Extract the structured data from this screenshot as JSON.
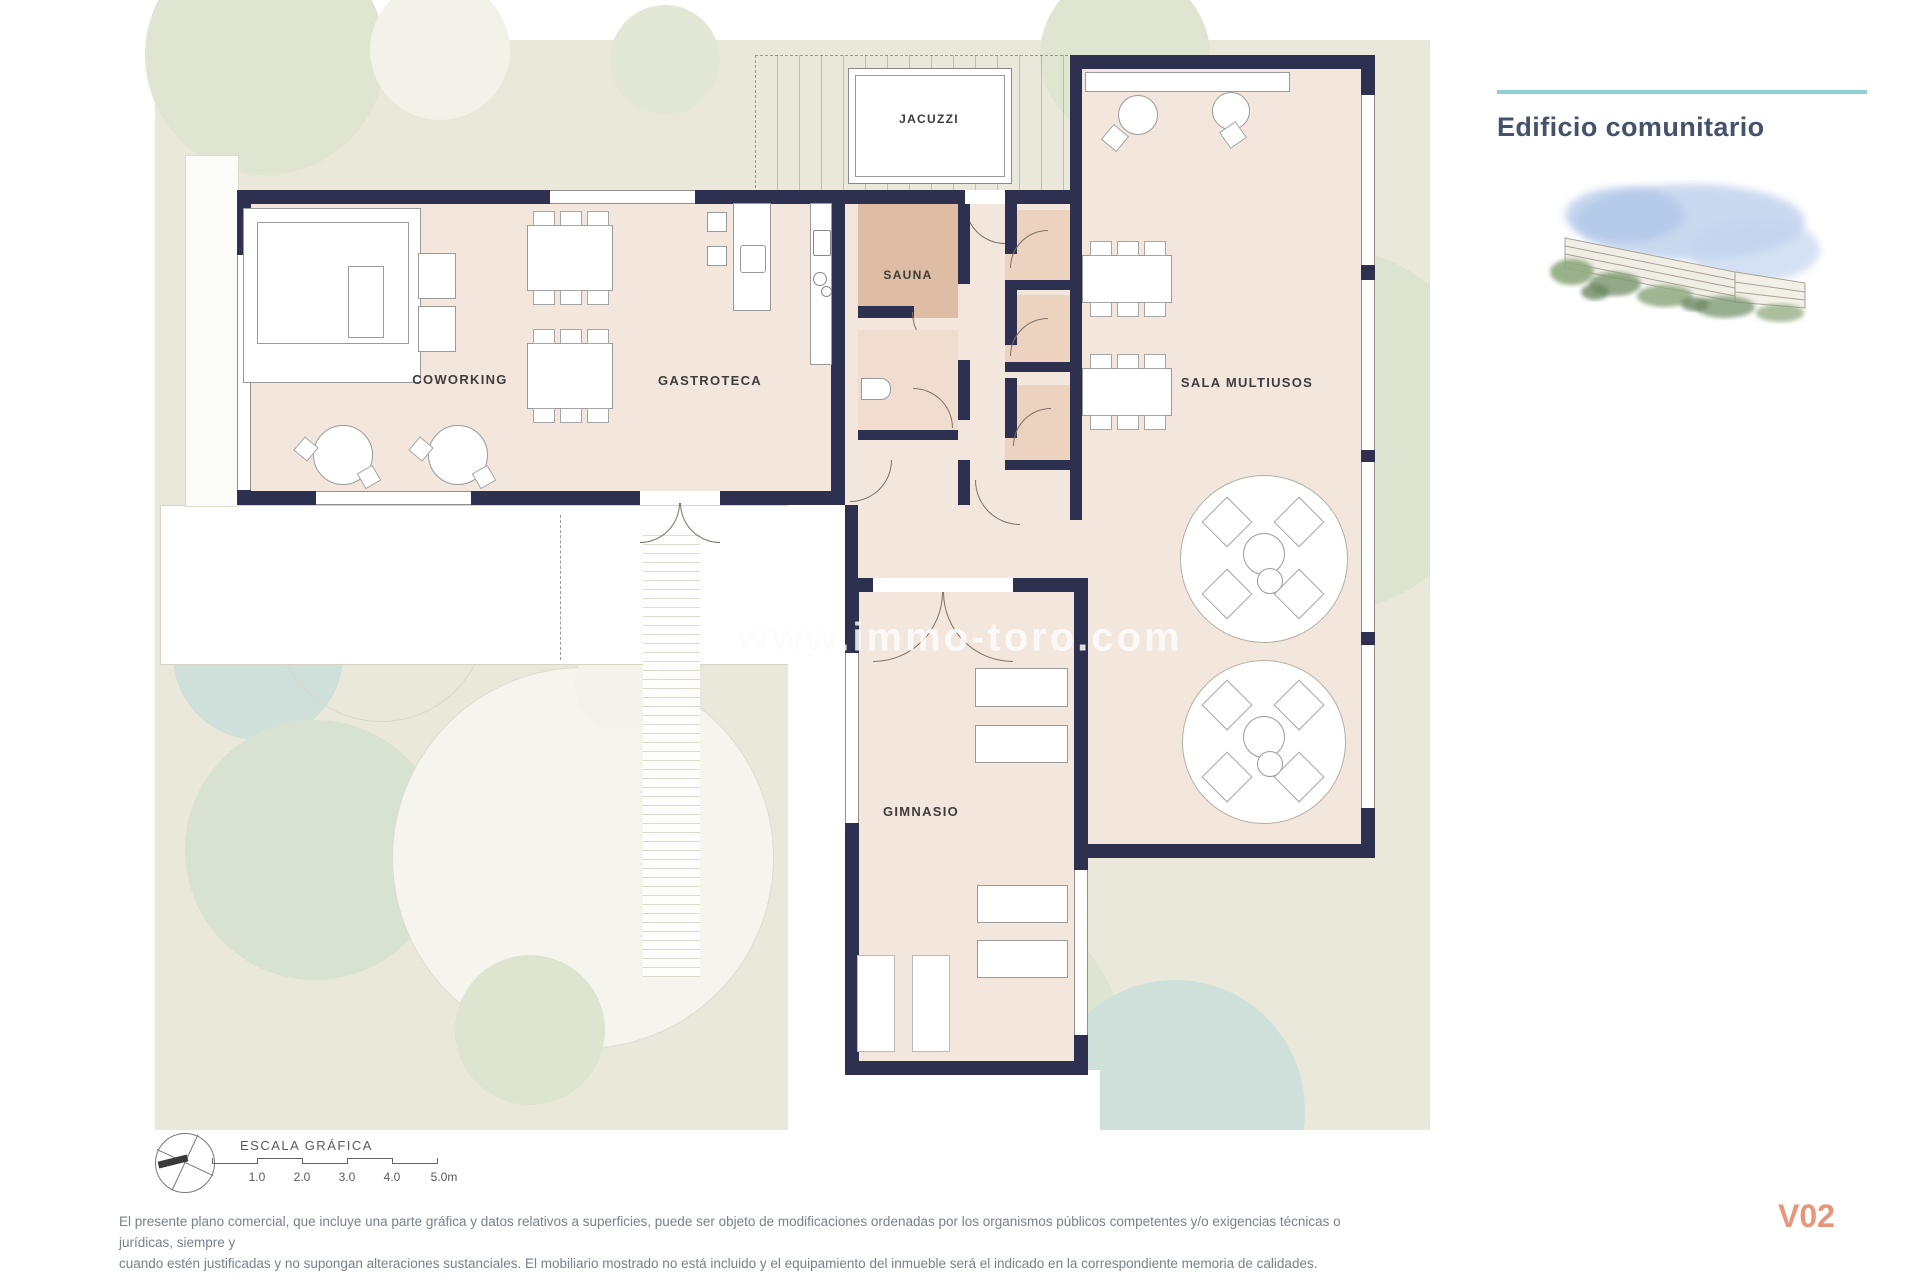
{
  "header": {
    "title": "Edificio comunitario"
  },
  "plan": {
    "room_labels": {
      "jacuzzi": "JACUZZI",
      "sauna": "SAUNA",
      "coworking": "COWORKING",
      "gastroteca": "GASTROTECA",
      "sala_multiusos": "SALA MULTIUSOS",
      "gimnasio": "GIMNASIO"
    },
    "watermark": "www.immo-toro.com"
  },
  "scale_bar": {
    "label": "ESCALA GRÁFICA",
    "ticks": [
      "1.0",
      "2.0",
      "3.0",
      "4.0",
      "5.0m"
    ]
  },
  "footer": {
    "disclaimer_line1": "El presente plano comercial, que incluye una parte gráfica y datos relativos a superficies, puede ser objeto de modificaciones ordenadas por los organismos públicos competentes y/o exigencias técnicas o jurídicas, siempre y",
    "disclaimer_line2": "cuando estén justificadas y no supongan alteraciones sustanciales. El mobiliario mostrado no está incluido y el equipamiento del inmueble será el indicado en la correspondiente memoria de calidades.",
    "version": "V02"
  },
  "colors": {
    "accent_teal": "#8ed0d4",
    "wall_navy": "#2e3050",
    "floor_pink": "#f3e6dd",
    "sauna_fill": "#dfbca4",
    "plan_background": "#e9e8da",
    "version_coral": "#e9957a",
    "title_color": "#44536b"
  }
}
